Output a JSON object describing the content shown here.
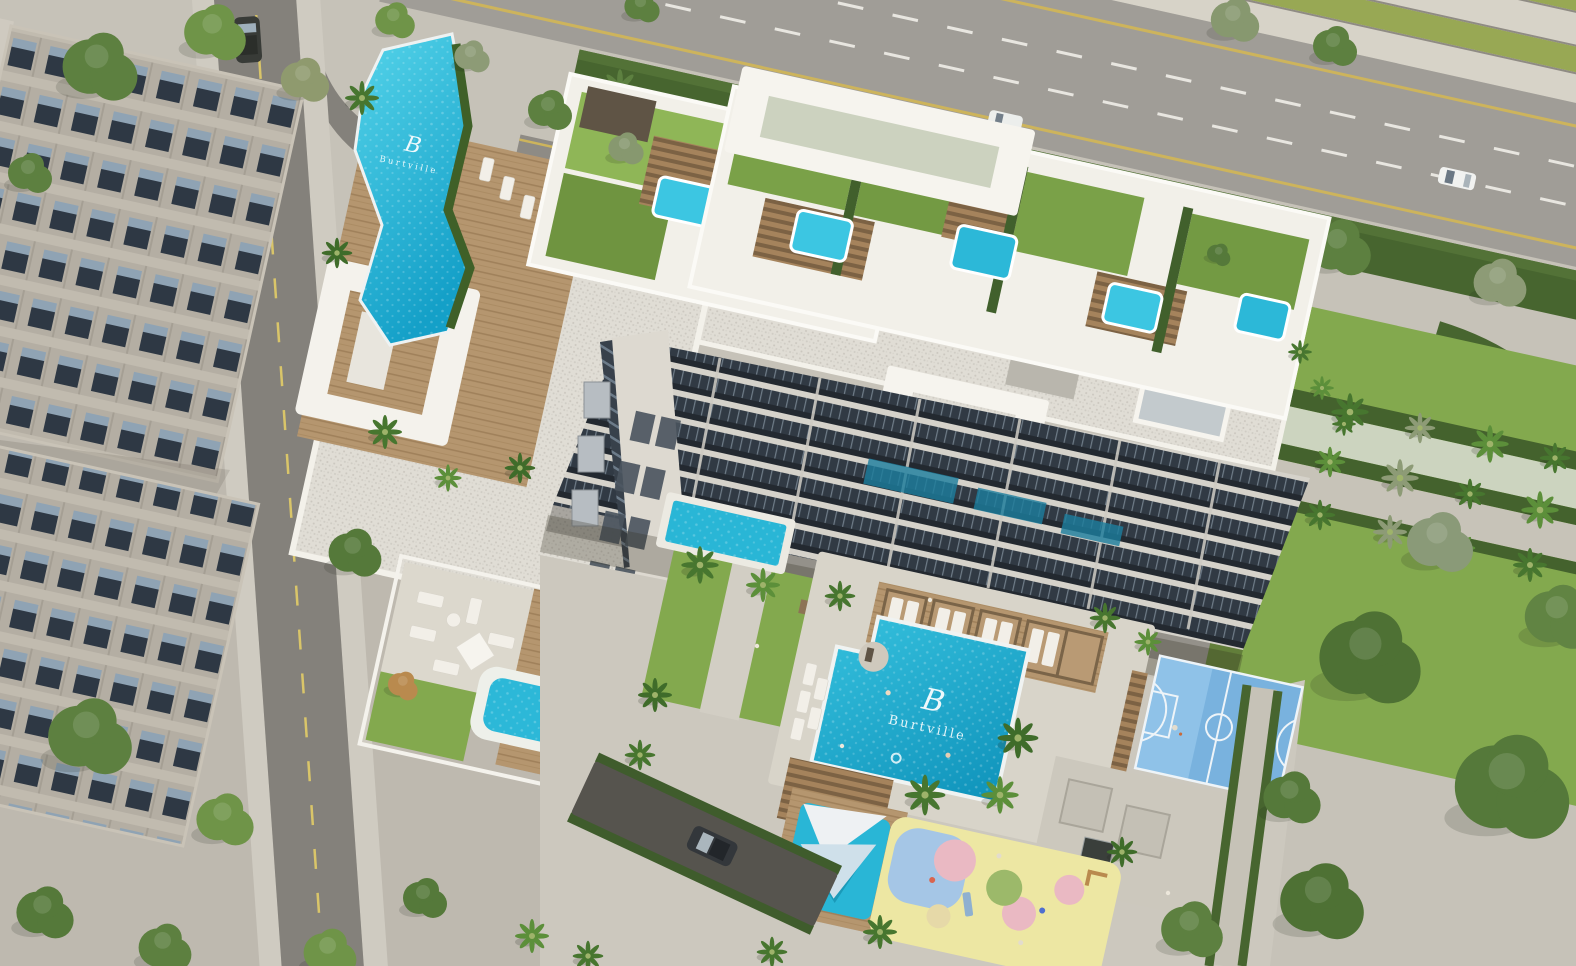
{
  "logo": {
    "letter": "B",
    "name": "Burtville"
  },
  "palette": {
    "pavement": "#c6c2b8",
    "deck_pale": "#d8d4c9",
    "highway": "#a09d97",
    "road": "#8e8b85",
    "street": "#84817b",
    "stripe_green": "#98a854",
    "hedge": "#47652f",
    "lawn": "#83a94e",
    "lawn_bright": "#8fb657",
    "pool": "#29b6d6",
    "rooftop_pool": "#3cc6e2",
    "jacuzzi": "#2cb8d8",
    "wood": "#b5966f",
    "building_white": "#f2f0e9",
    "gravel_roof": "#e0ddd5",
    "glass": "#313a44",
    "court_blue": "#79b2de",
    "play_base": "#ede7a3",
    "play_pink": "#eab9c3",
    "play_blue": "#a5c6e6",
    "play_green": "#9cb96a",
    "sail_white": "#eef1f3"
  }
}
